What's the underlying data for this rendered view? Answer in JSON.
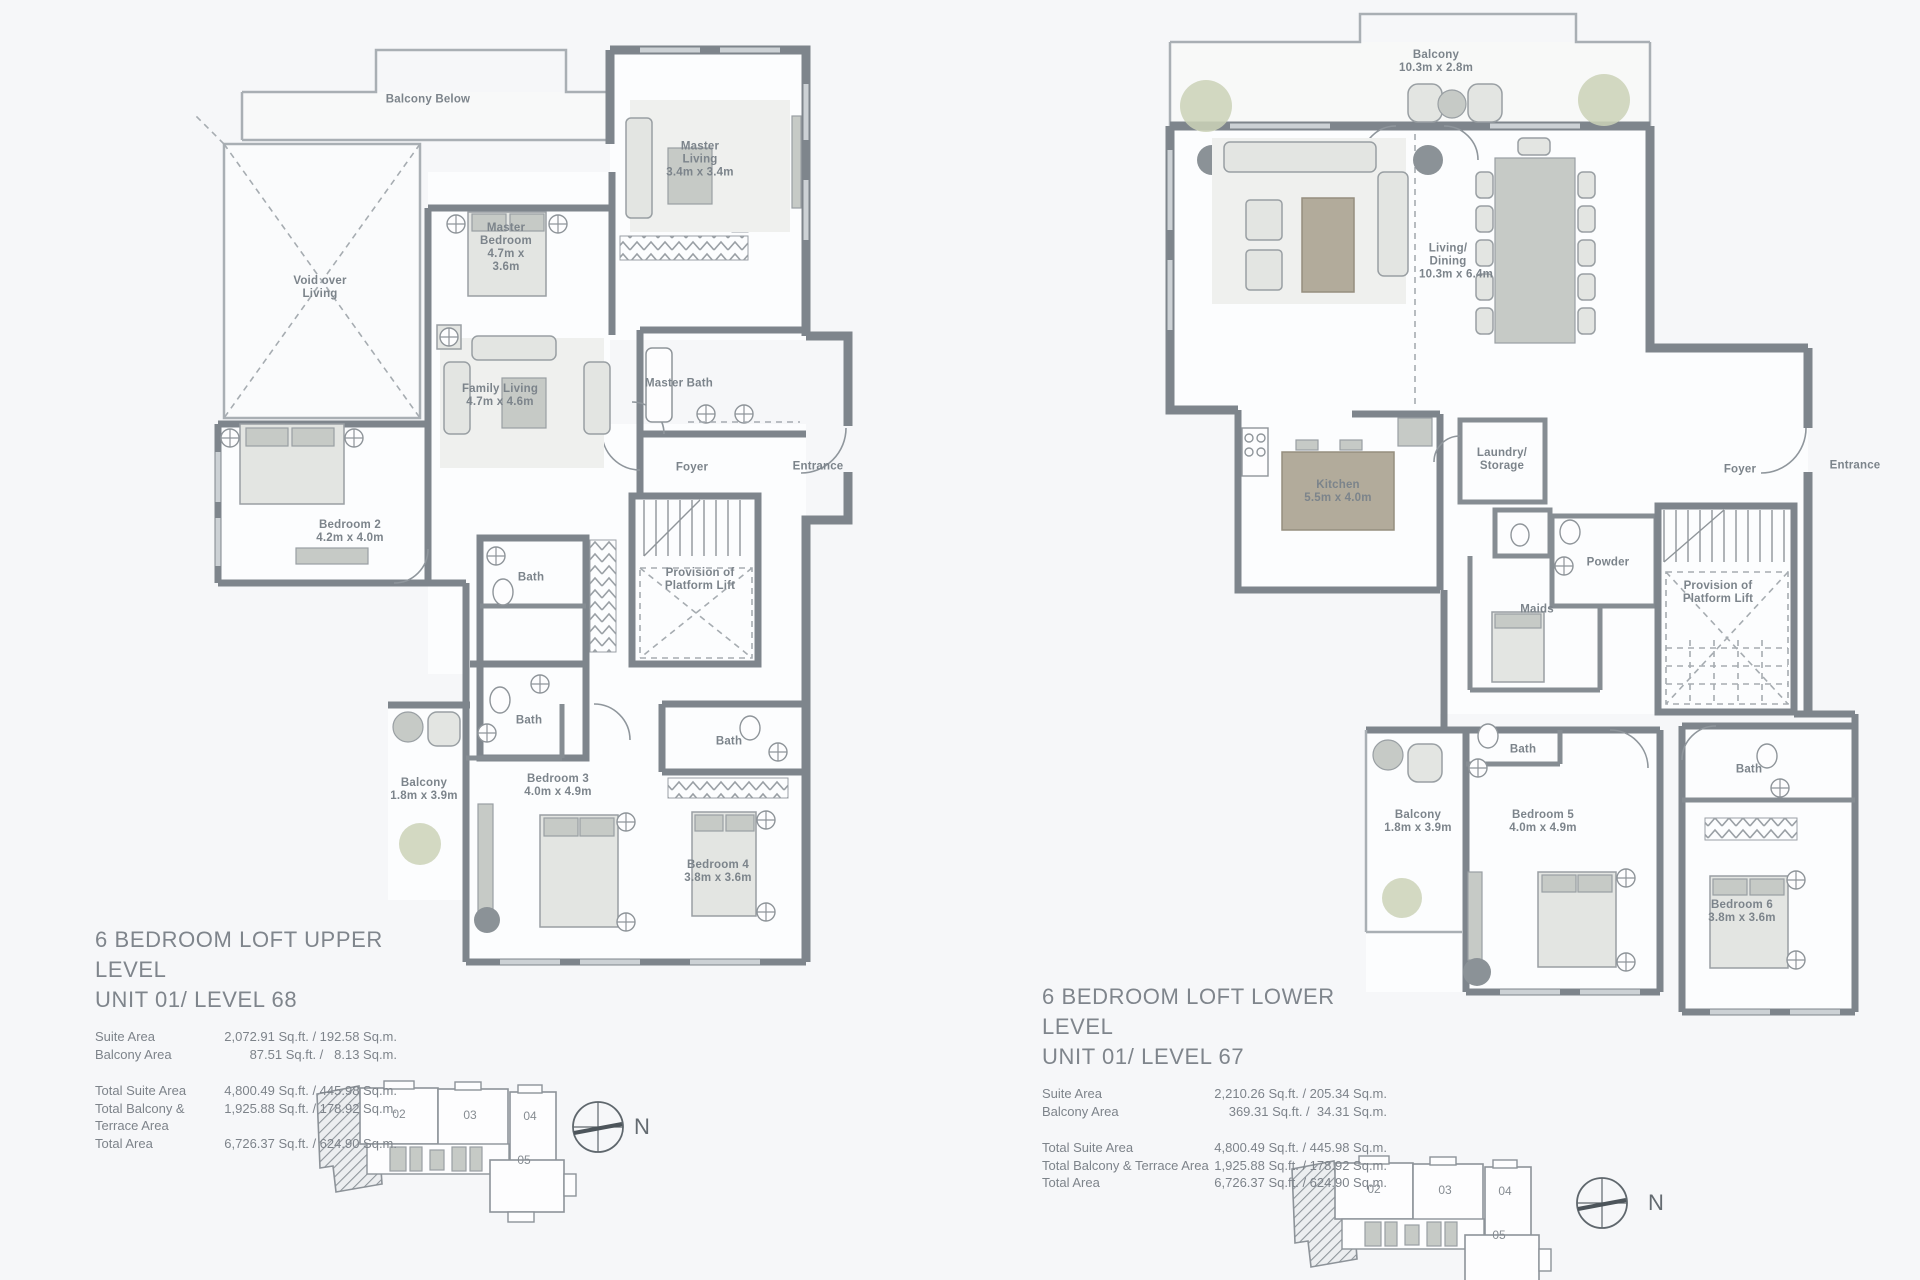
{
  "palette": {
    "background": "#f6f7f9",
    "wall_gray": "#7e858c",
    "light_wall": "#a9afb4",
    "furniture_gray": "#c6cac6",
    "island_tan": "#b2ab9b",
    "plant_green": "#cbd2b7",
    "label_gray": "#7c848b"
  },
  "upper": {
    "title": "6 BEDROOM LOFT UPPER LEVEL",
    "unit": "UNIT 01/ LEVEL 68",
    "stats": [
      {
        "label": "Suite Area",
        "value": "2,072.91 Sq.ft. / 192.58 Sq.m."
      },
      {
        "label": "Balcony Area",
        "value": "87.51 Sq.ft. /   8.13 Sq.m."
      }
    ],
    "totals": [
      {
        "label": "Total Suite Area",
        "value": "4,800.49 Sq.ft. / 445.98 Sq.m."
      },
      {
        "label": "Total Balcony & Terrace Area",
        "value": "1,925.88 Sq.ft. / 178.92 Sq.m."
      },
      {
        "label": "Total Area",
        "value": "6,726.37 Sq.ft. / 624.90 Sq.m."
      }
    ],
    "rooms": {
      "balcony_below": {
        "name": "Balcony Below",
        "dims": ""
      },
      "master_living": {
        "name": "Master Living",
        "dims": "3.4m x 3.4m"
      },
      "master_bedroom": {
        "name": "Master Bedroom",
        "dims": "4.7m x 3.6m"
      },
      "void": {
        "name": "Void over Living",
        "dims": ""
      },
      "family_living": {
        "name": "Family Living",
        "dims": "4.7m x 4.6m"
      },
      "master_bath": {
        "name": "Master Bath",
        "dims": ""
      },
      "foyer": {
        "name": "Foyer",
        "dims": ""
      },
      "entrance": {
        "name": "Entrance",
        "dims": ""
      },
      "bedroom2": {
        "name": "Bedroom 2",
        "dims": "4.2m x 4.0m"
      },
      "bath_a": {
        "name": "Bath",
        "dims": ""
      },
      "provision": {
        "name": "Provision of Platform Lift",
        "dims": ""
      },
      "bath_b": {
        "name": "Bath",
        "dims": ""
      },
      "balcony": {
        "name": "Balcony",
        "dims": "1.8m x 3.9m"
      },
      "bedroom3": {
        "name": "Bedroom 3",
        "dims": "4.0m x 4.9m"
      },
      "bath_c": {
        "name": "Bath",
        "dims": ""
      },
      "bedroom4": {
        "name": "Bedroom 4",
        "dims": "3.8m x 3.6m"
      }
    }
  },
  "lower": {
    "title": "6 BEDROOM LOFT LOWER LEVEL",
    "unit": "UNIT 01/ LEVEL 67",
    "stats": [
      {
        "label": "Suite Area",
        "value": "2,210.26 Sq.ft. / 205.34 Sq.m."
      },
      {
        "label": "Balcony Area",
        "value": "369.31 Sq.ft. /  34.31 Sq.m."
      }
    ],
    "totals": [
      {
        "label": "Total Suite Area",
        "value": "4,800.49 Sq.ft. / 445.98 Sq.m."
      },
      {
        "label": "Total Balcony & Terrace Area",
        "value": "1,925.88 Sq.ft. / 178.92 Sq.m."
      },
      {
        "label": "Total Area",
        "value": "6,726.37 Sq.ft. / 624.90 Sq.m."
      }
    ],
    "rooms": {
      "balcony_top": {
        "name": "Balcony",
        "dims": "10.3m x 2.8m"
      },
      "living_dining": {
        "name": "Living/ Dining",
        "dims": "10.3m x 6.4m"
      },
      "kitchen": {
        "name": "Kitchen",
        "dims": "5.5m x 4.0m"
      },
      "laundry": {
        "name": "Laundry/ Storage",
        "dims": ""
      },
      "powder": {
        "name": "Powder",
        "dims": ""
      },
      "maids": {
        "name": "Maids",
        "dims": ""
      },
      "foyer": {
        "name": "Foyer",
        "dims": ""
      },
      "entrance": {
        "name": "Entrance",
        "dims": ""
      },
      "provision": {
        "name": "Provision of Platform Lift",
        "dims": ""
      },
      "bath_a": {
        "name": "Bath",
        "dims": ""
      },
      "balcony": {
        "name": "Balcony",
        "dims": "1.8m x 3.9m"
      },
      "bedroom5": {
        "name": "Bedroom 5",
        "dims": "4.0m x 4.9m"
      },
      "bath_b": {
        "name": "Bath",
        "dims": ""
      },
      "bedroom6": {
        "name": "Bedroom 6",
        "dims": "3.8m x 3.6m"
      }
    }
  },
  "keyplan": {
    "units": [
      "02",
      "03",
      "04",
      "05"
    ],
    "north": "N"
  }
}
